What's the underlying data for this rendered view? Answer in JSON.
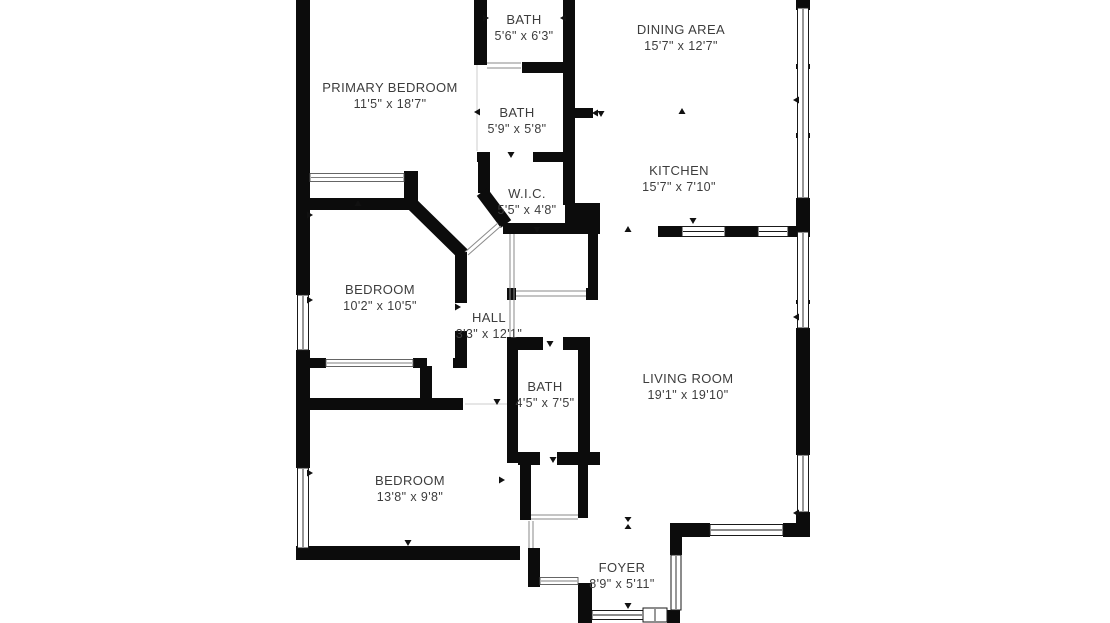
{
  "plan": {
    "type": "floor-plan",
    "background_color": "#ffffff",
    "wall_color": "#0c0c0c",
    "text_color": "#3d3d3d"
  },
  "rooms": [
    {
      "id": "bath-top",
      "name": "BATH",
      "dims": "5'6\" x 6'3\""
    },
    {
      "id": "dining-area",
      "name": "DINING AREA",
      "dims": "15'7\" x 12'7\""
    },
    {
      "id": "primary-bedroom",
      "name": "PRIMARY BEDROOM",
      "dims": "11'5\" x 18'7\""
    },
    {
      "id": "bath-middle",
      "name": "BATH",
      "dims": "5'9\" x 5'8\""
    },
    {
      "id": "kitchen",
      "name": "KITCHEN",
      "dims": "15'7\" x 7'10\""
    },
    {
      "id": "wic",
      "name": "W.I.C.",
      "dims": "5'5\" x 4'8\""
    },
    {
      "id": "bedroom-1",
      "name": "BEDROOM",
      "dims": "10'2\" x 10'5\""
    },
    {
      "id": "hall",
      "name": "HALL",
      "dims": "3'3\" x 12'1\""
    },
    {
      "id": "living-room",
      "name": "LIVING ROOM",
      "dims": "19'1\" x 19'10\""
    },
    {
      "id": "bath-lower",
      "name": "BATH",
      "dims": "4'5\" x 7'5\""
    },
    {
      "id": "bedroom-2",
      "name": "BEDROOM",
      "dims": "13'8\" x 9'8\""
    },
    {
      "id": "foyer",
      "name": "FOYER",
      "dims": "8'9\" x 5'11\""
    }
  ]
}
